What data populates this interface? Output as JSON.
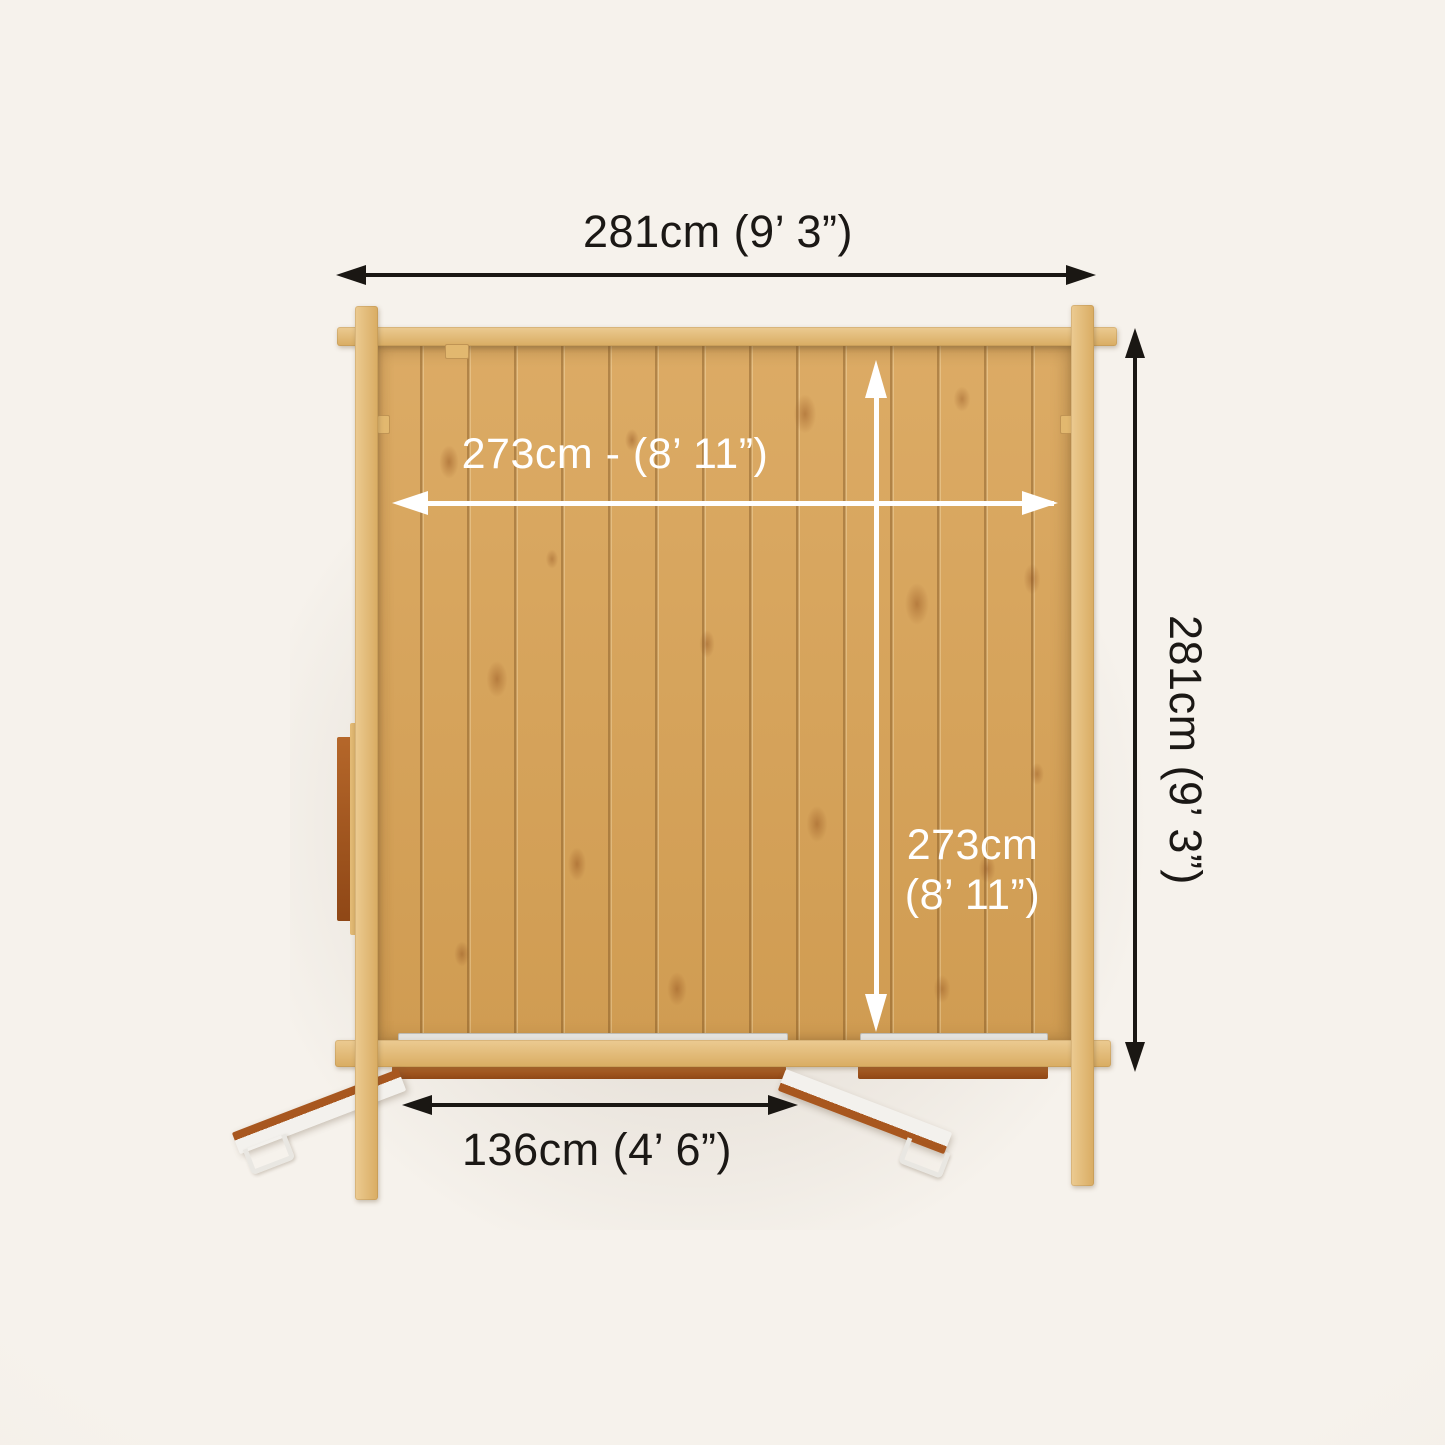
{
  "title": "Log cabin top-down dimension diagram",
  "dimensions": {
    "overall_width": {
      "label": "281cm  (9’ 3”)",
      "cm": 281,
      "imperial": "9’ 3”"
    },
    "overall_depth": {
      "label": "281cm  (9’ 3”)",
      "cm": 281,
      "imperial": "9’ 3”"
    },
    "internal_width": {
      "label": "273cm - (8’ 11”)",
      "cm": 273,
      "imperial": "8’ 11”"
    },
    "internal_depth": {
      "line1": "273cm",
      "line2": "(8’ 11”)",
      "cm": 273,
      "imperial": "8’ 11”"
    },
    "door_width": {
      "label": "136cm  (4’ 6”)",
      "cm": 136,
      "imperial": "4’ 6”"
    }
  },
  "colors": {
    "outer_dimension": "#1a1713",
    "inner_dimension": "#ffffff",
    "wall_log": "#e2bb79",
    "floor_plank": "#d6a45c",
    "frame_brown": "#a4571f",
    "door_face": "#f3f1ed",
    "background": "#f5f1eb"
  }
}
